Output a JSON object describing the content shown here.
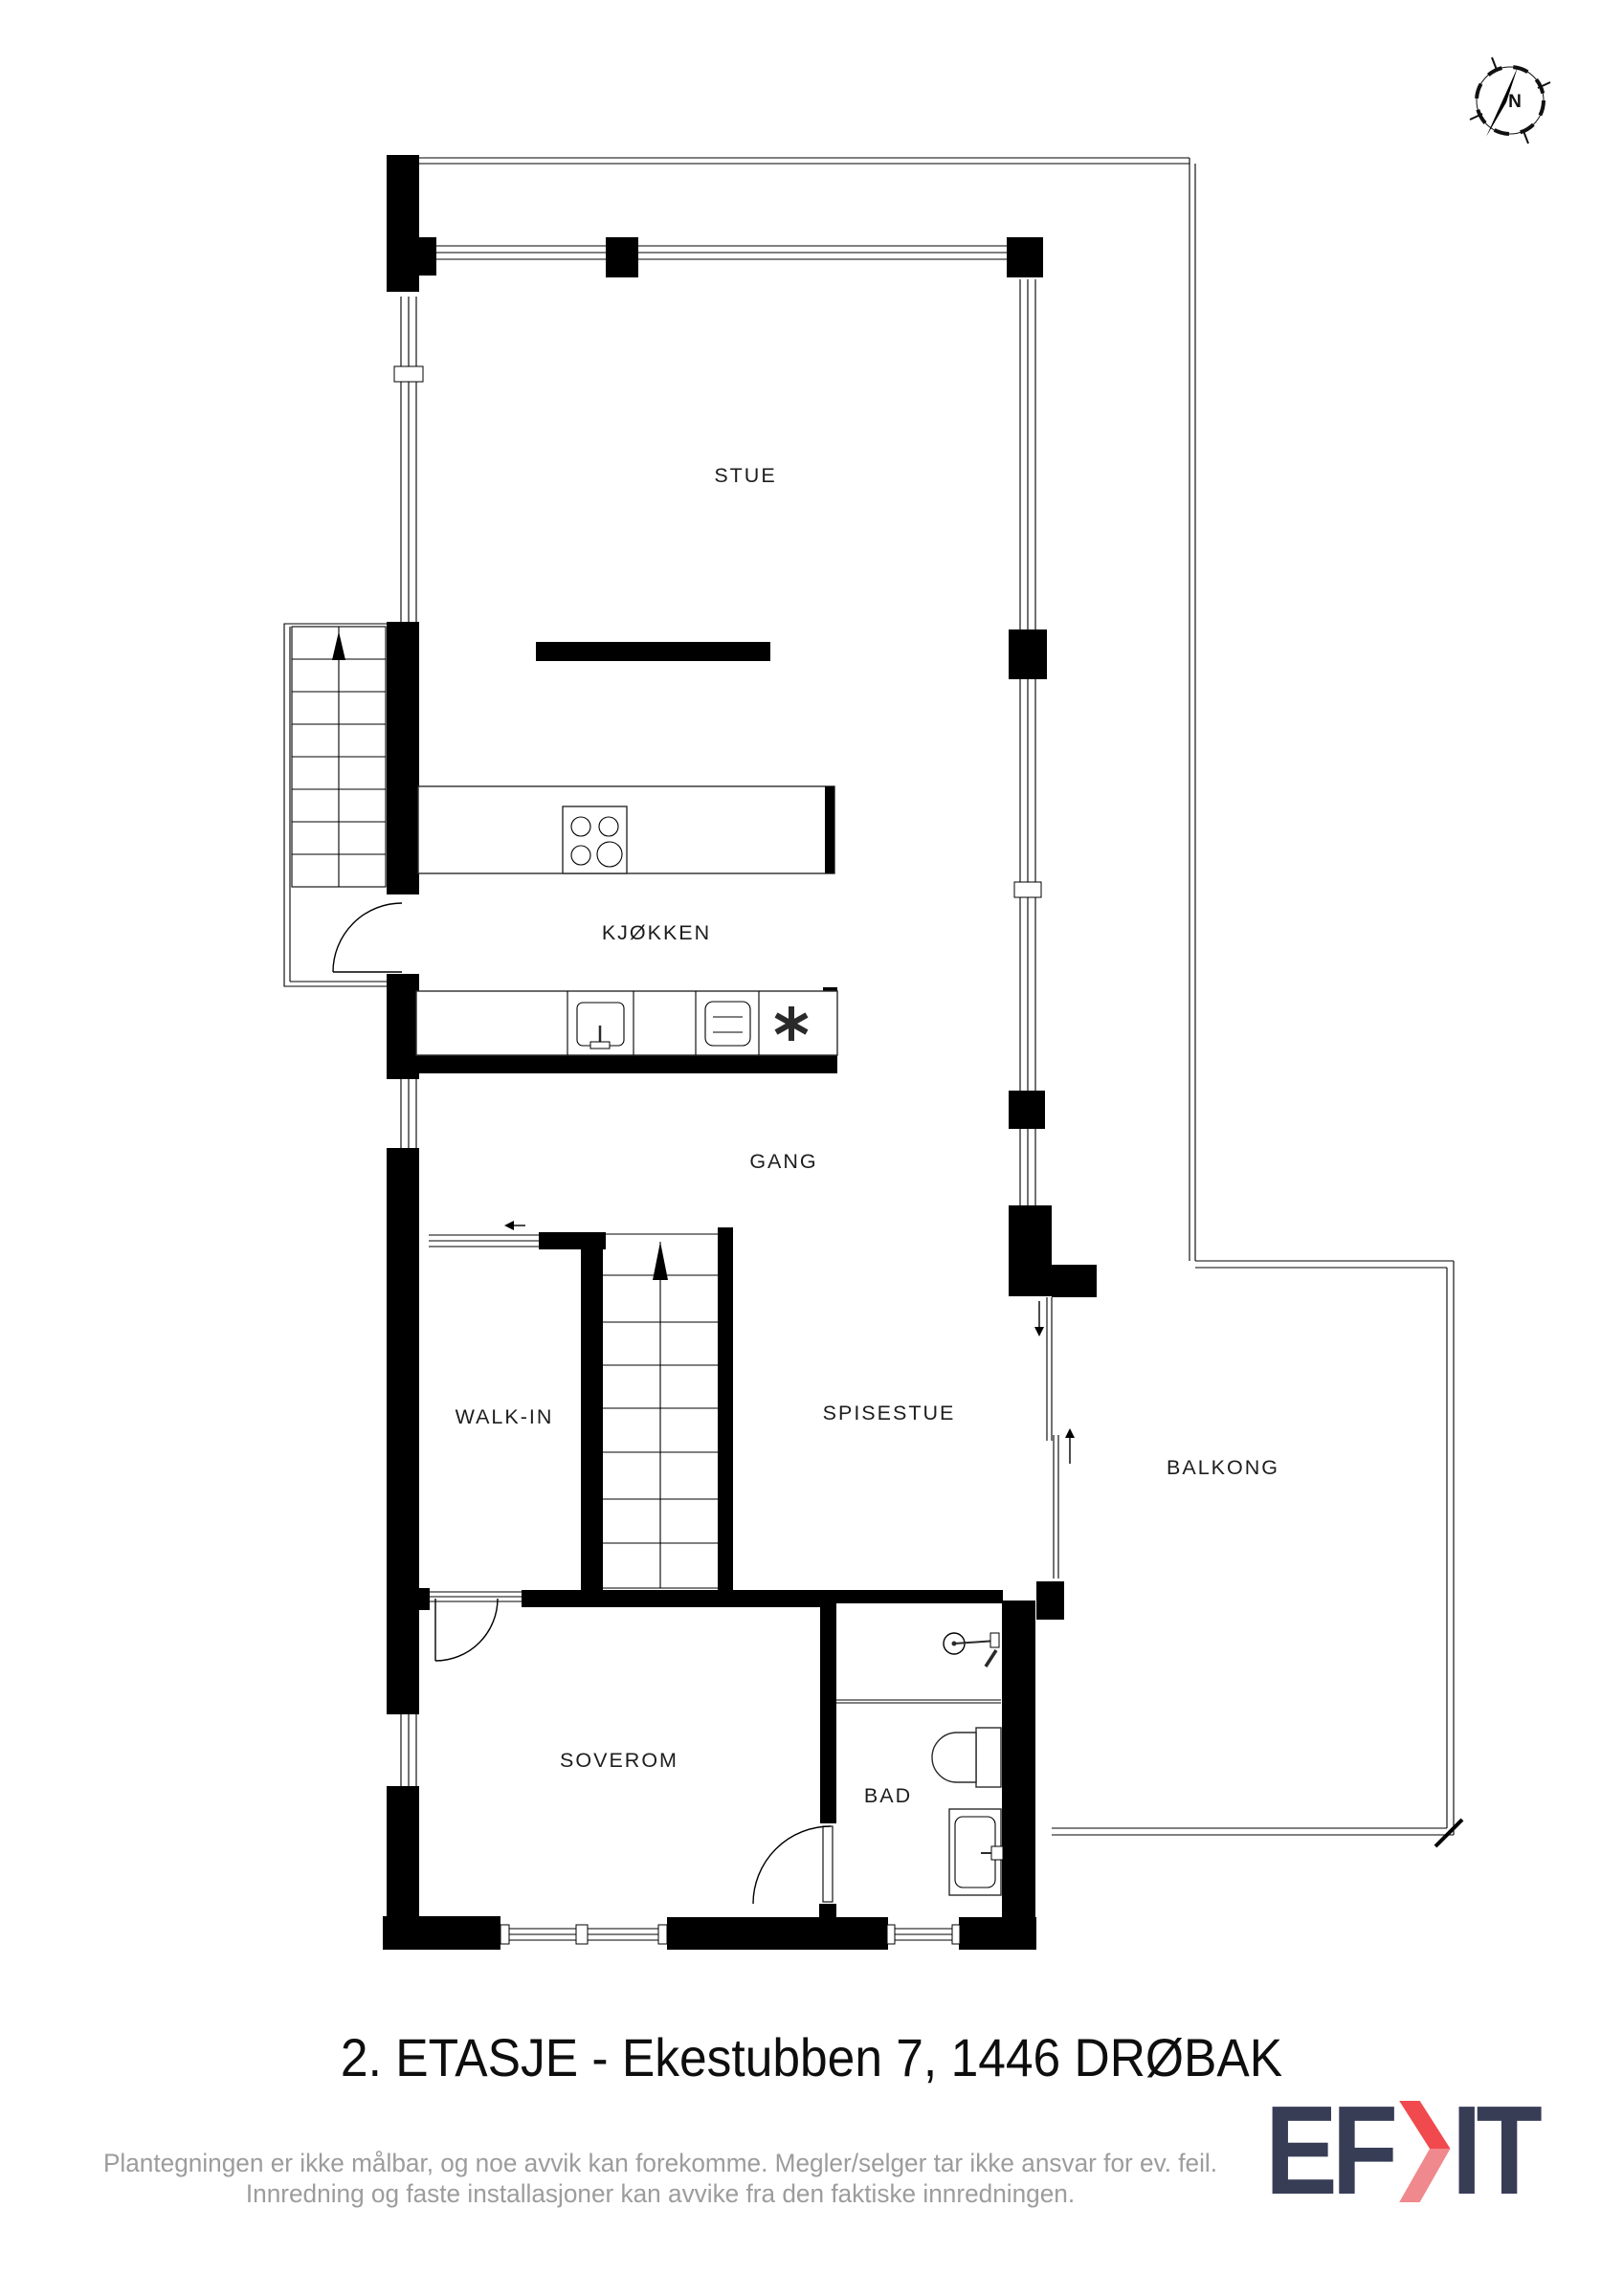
{
  "plan": {
    "rooms": {
      "stue": "STUE",
      "kjokken": "KJØKKEN",
      "gang": "GANG",
      "walkin": "WALK-IN",
      "spisestue": "SPISESTUE",
      "balkong": "BALKONG",
      "soverom": "SOVEROM",
      "bad": "BAD"
    },
    "compass": {
      "north": "N"
    }
  },
  "footer": {
    "title": "2. ETASJE - Ekestubben 7, 1446 DRØBAK",
    "disclaimer_line1": "Plantegningen er ikke målbar, og noe avvik kan forekomme. Megler/selger tar ikke ansvar for ev. feil.",
    "disclaimer_line2": "Innredning og faste installasjoner kan avvike fra den faktiske innredningen.",
    "logo_part1": "EF",
    "logo_part2": "IT"
  },
  "colors": {
    "wall": "#000000",
    "label": "#1d1d1d",
    "disclaimer_gray": "#9c9c9c",
    "logo_navy": "#383d56",
    "logo_red": "#f04a4e",
    "logo_red_light": "#f0898d"
  }
}
